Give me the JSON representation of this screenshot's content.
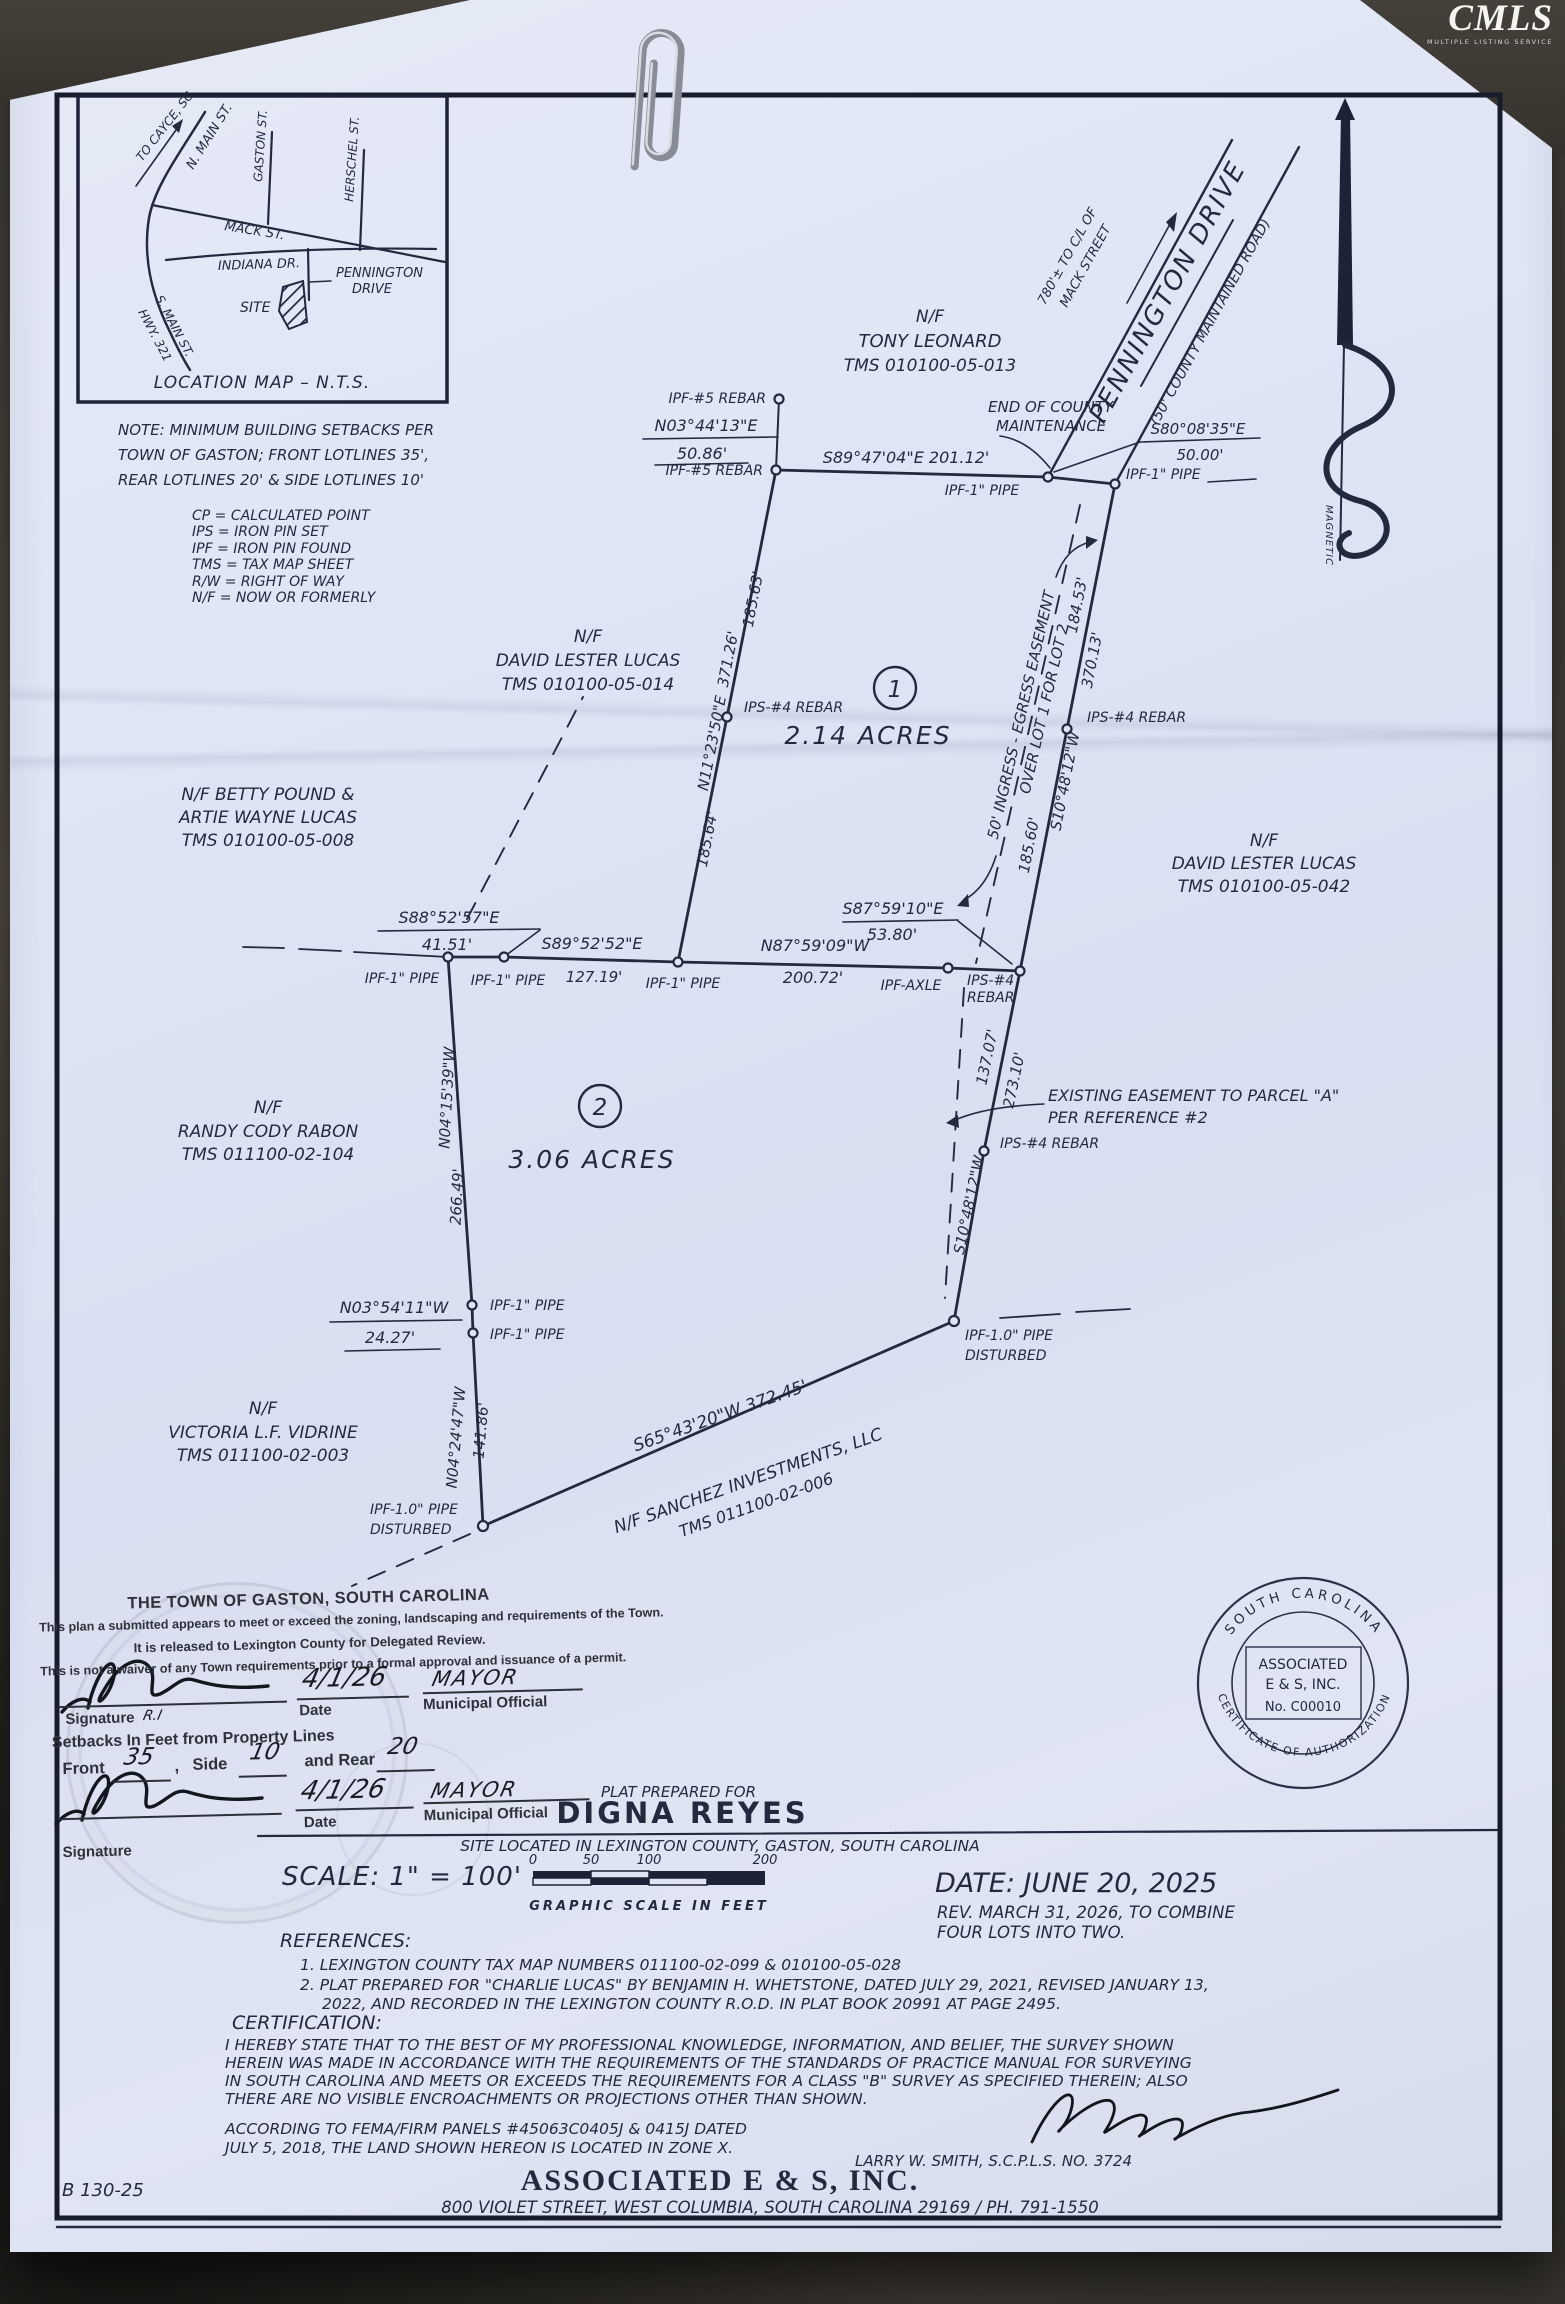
{
  "photo": {
    "cmls": "CMLS",
    "cmls_sub": "MULTIPLE LISTING SERVICE"
  },
  "locmap": {
    "caption": "LOCATION MAP – N.T.S.",
    "to_cayce": "TO CAYCE, SC",
    "n_main": "N. MAIN ST.",
    "gaston": "GASTON ST.",
    "herschel": "HERSCHEL ST.",
    "mack": "MACK ST.",
    "indiana": "INDIANA DR.",
    "pennington_l1": "PENNINGTON",
    "pennington_l2": "DRIVE",
    "s_main_l1": "S. MAIN ST.",
    "s_main_l2": "HWY. 321",
    "site": "SITE"
  },
  "note": {
    "l1": "NOTE: MINIMUM BUILDING SETBACKS PER",
    "l2": "TOWN OF GASTON; FRONT LOTLINES 35',",
    "l3": "REAR LOTLINES 20' & SIDE LOTLINES 10'"
  },
  "legend": {
    "l1": "CP = CALCULATED POINT",
    "l2": "IPS = IRON PIN SET",
    "l3": "IPF = IRON PIN FOUND",
    "l4": "TMS = TAX MAP SHEET",
    "l5": "R/W = RIGHT OF WAY",
    "l6": "N/F = NOW OR FORMERLY"
  },
  "road": {
    "name": "PENNINGTON DRIVE",
    "desc": "(50' COUNTY MAINTAINED ROAD)",
    "tie1": "780'± TO C/L OF",
    "tie2": "MACK STREET",
    "end1": "END OF COUNTY",
    "end2": "MAINTENANCE",
    "magnetic": "MAGNETIC"
  },
  "adj": {
    "leonard": [
      "N/F",
      "TONY LEONARD",
      "TMS 010100-05-013"
    ],
    "lucas14": [
      "N/F",
      "DAVID LESTER LUCAS",
      "TMS 010100-05-014"
    ],
    "pound": [
      "N/F BETTY POUND &",
      "ARTIE WAYNE LUCAS",
      "TMS 010100-05-008"
    ],
    "lucas42": [
      "N/F",
      "DAVID LESTER LUCAS",
      "TMS 010100-05-042"
    ],
    "rabon": [
      "N/F",
      "RANDY CODY RABON",
      "TMS 011100-02-104"
    ],
    "vidrine": [
      "N/F",
      "VICTORIA L.F. VIDRINE",
      "TMS 011100-02-003"
    ],
    "sanchez": [
      "N/F SANCHEZ INVESTMENTS, LLC",
      "TMS 011100-02-006"
    ]
  },
  "mk": {
    "ipf5": "IPF-#5 REBAR",
    "ipf1": "IPF-1\" PIPE",
    "ips4": "IPS-#4 REBAR",
    "ips4a": "IPS-#4",
    "ips4b": "REBAR",
    "axle": "IPF-AXLE",
    "ipf10": "IPF-1.0\" PIPE",
    "dist": "DISTURBED"
  },
  "crs": {
    "c1": "N03°44'13\"E",
    "c1d": "50.86'",
    "c2": "S89°47'04\"E   201.12'",
    "c3": "S80°08'35\"E",
    "c3d": "50.00'",
    "w1": "N11°23'50\"E",
    "w1d": "371.26'",
    "w1a": "185.63'",
    "w1b": "185.64'",
    "e1a": "184.53'",
    "e1d": "370.13'",
    "e1brg": "S10°48'12\"W",
    "e1b": "185.60'",
    "m1": "S88°52'57\"E",
    "m1d": "41.51'",
    "m2": "S89°52'52\"E",
    "m2d": "127.19'",
    "m3": "N87°59'09\"W",
    "m3d": "200.72'",
    "m4": "S87°59'10\"E",
    "m4d": "53.80'",
    "e2a": "137.07'",
    "e2b": "273.10'",
    "e2brg": "S10°48'12\"W",
    "w2": "N04°15'39\"W",
    "w2d": "266.49'",
    "jog": "N03°54'11\"W",
    "jogd": "24.27'",
    "w3": "N04°24'47\"W",
    "w3d": "141.86'",
    "s1": "S65°43'20\"W   372.45'"
  },
  "parcel1": {
    "num": "1",
    "area": "2.14 ACRES"
  },
  "parcel2": {
    "num": "2",
    "area": "3.06 ACRES"
  },
  "esmt": {
    "in1": "50' INGRESS - EGRESS EASEMENT",
    "in2": "OVER LOT 1 FOR LOT 2",
    "ex1": "EXISTING EASEMENT TO PARCEL \"A\"",
    "ex2": "PER REFERENCE #2"
  },
  "approval": {
    "title": "THE TOWN OF GASTON, SOUTH CAROLINA",
    "line1": "This plan a submitted appears to meet or exceed the zoning, landscaping and requirements of the Town.",
    "line2": "It is released to Lexington County for Delegated Review.",
    "line3": "This is not a waiver of any Town requirements prior to a formal approval and issuance of a permit.",
    "sig_label": "Signature",
    "date_label": "Date",
    "official_label": "Municipal Official",
    "date_value": "4/1/26",
    "official_value": "MAYOR",
    "initials": "R.I",
    "setbacks_heading": "Setbacks In Feet from Property Lines",
    "front_label": "Front",
    "front_value": "35",
    "comma": ",",
    "side_label": "Side",
    "side_value": "10",
    "rear_label": "and Rear",
    "rear_value": "20"
  },
  "title": {
    "prepared": "PLAT PREPARED FOR",
    "client": "DIGNA REYES",
    "site": "SITE LOCATED IN LEXINGTON COUNTY, GASTON, SOUTH CAROLINA",
    "scale": "SCALE: 1\"  =  100'",
    "ticks": [
      "0",
      "50",
      "100",
      "200"
    ],
    "scale_cap": "GRAPHIC SCALE IN FEET",
    "date": "DATE: JUNE 20, 2025",
    "rev1": "REV. MARCH 31, 2026, TO COMBINE",
    "rev2": "FOUR LOTS INTO TWO."
  },
  "refs": {
    "h": "REFERENCES:",
    "l1": "1. LEXINGTON COUNTY TAX MAP NUMBERS 011100-02-099 & 010100-05-028",
    "l2": "2. PLAT PREPARED FOR \"CHARLIE LUCAS\" BY BENJAMIN H. WHETSTONE, DATED JULY 29, 2021, REVISED JANUARY 13,",
    "l3": "2022, AND RECORDED IN THE LEXINGTON COUNTY R.O.D. IN PLAT BOOK 20991 AT PAGE 2495."
  },
  "cert": {
    "h": "CERTIFICATION:",
    "l1": "I HEREBY STATE THAT TO THE BEST OF MY PROFESSIONAL KNOWLEDGE, INFORMATION, AND BELIEF, THE SURVEY SHOWN",
    "l2": "HEREIN WAS MADE IN ACCORDANCE WITH THE REQUIREMENTS OF THE STANDARDS OF PRACTICE MANUAL FOR SURVEYING",
    "l3": "IN SOUTH CAROLINA AND MEETS OR EXCEEDS THE REQUIREMENTS FOR A CLASS \"B\" SURVEY AS SPECIFIED THEREIN; ALSO",
    "l4": "THERE ARE NO VISIBLE ENCROACHMENTS OR PROJECTIONS OTHER THAN SHOWN.",
    "f1": "ACCORDING TO FEMA/FIRM PANELS #45063C0405J & 0415J DATED",
    "f2": "JULY 5, 2018, THE LAND SHOWN HEREON IS LOCATED IN ZONE X.",
    "surveyor": "LARRY W. SMITH, S.C.P.L.S. NO. 3724"
  },
  "firm": {
    "name": "ASSOCIATED  E  &  S,  INC.",
    "addr": "800 VIOLET STREET, WEST COLUMBIA, SOUTH CAROLINA 29169 / PH. 791-1550"
  },
  "seal": {
    "arc1": "SOUTH CAROLINA",
    "arc2": "CERTIFICATE OF AUTHORIZATION",
    "n1": "ASSOCIATED",
    "n2": "E & S, INC.",
    "n3": "No. C00010"
  },
  "file_no": "B 130-25"
}
